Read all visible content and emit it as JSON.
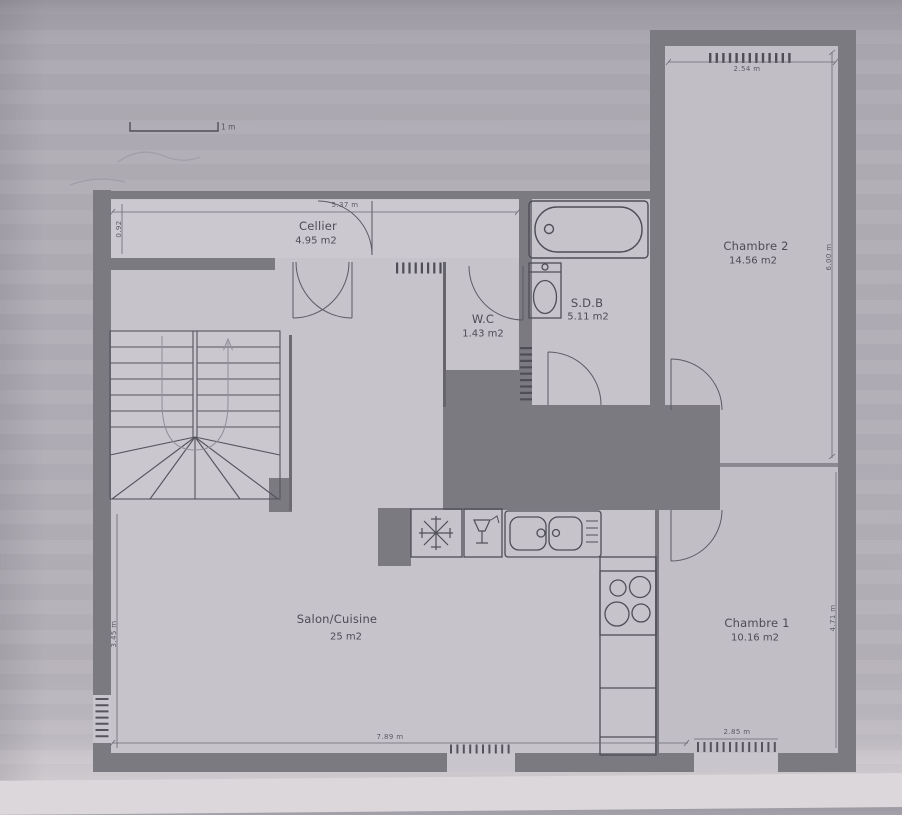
{
  "scale": {
    "label": "1 m"
  },
  "rooms": {
    "cellier": {
      "name": "Cellier",
      "area": "4.95 m2"
    },
    "chambre2": {
      "name": "Chambre 2",
      "area": "14.56 m2"
    },
    "wc": {
      "name": "W.C",
      "area": "1.43 m2"
    },
    "sdb": {
      "name": "S.D.B",
      "area": "5.11 m2"
    },
    "salon": {
      "name": "Salon/Cuisine",
      "area": "25 m2"
    },
    "chambre1": {
      "name": "Chambre 1",
      "area": "10.16 m2"
    }
  },
  "dimensions": {
    "cellier_width": "5.37 m",
    "cellier_depth": "0.92",
    "chambre2_window": "2.54 m",
    "chambre2_height": "6.00 m",
    "chambre1_height": "4.71 m",
    "salon_height": "3.45 m",
    "salon_width": "7.89 m",
    "chambre1_window": "2.85 m"
  },
  "icons": {
    "fridge": "snowflake-icon",
    "dishwasher": "glass-icon",
    "sink": "double-sink-icon",
    "cooktop": "four-burner-icon",
    "bath": "bathtub-icon",
    "toilet": "toilet-icon"
  },
  "colors": {
    "paper": "#b2aeb6",
    "wall": "#7b7a81",
    "floor": "#c6c3ca",
    "line": "#55545c"
  }
}
